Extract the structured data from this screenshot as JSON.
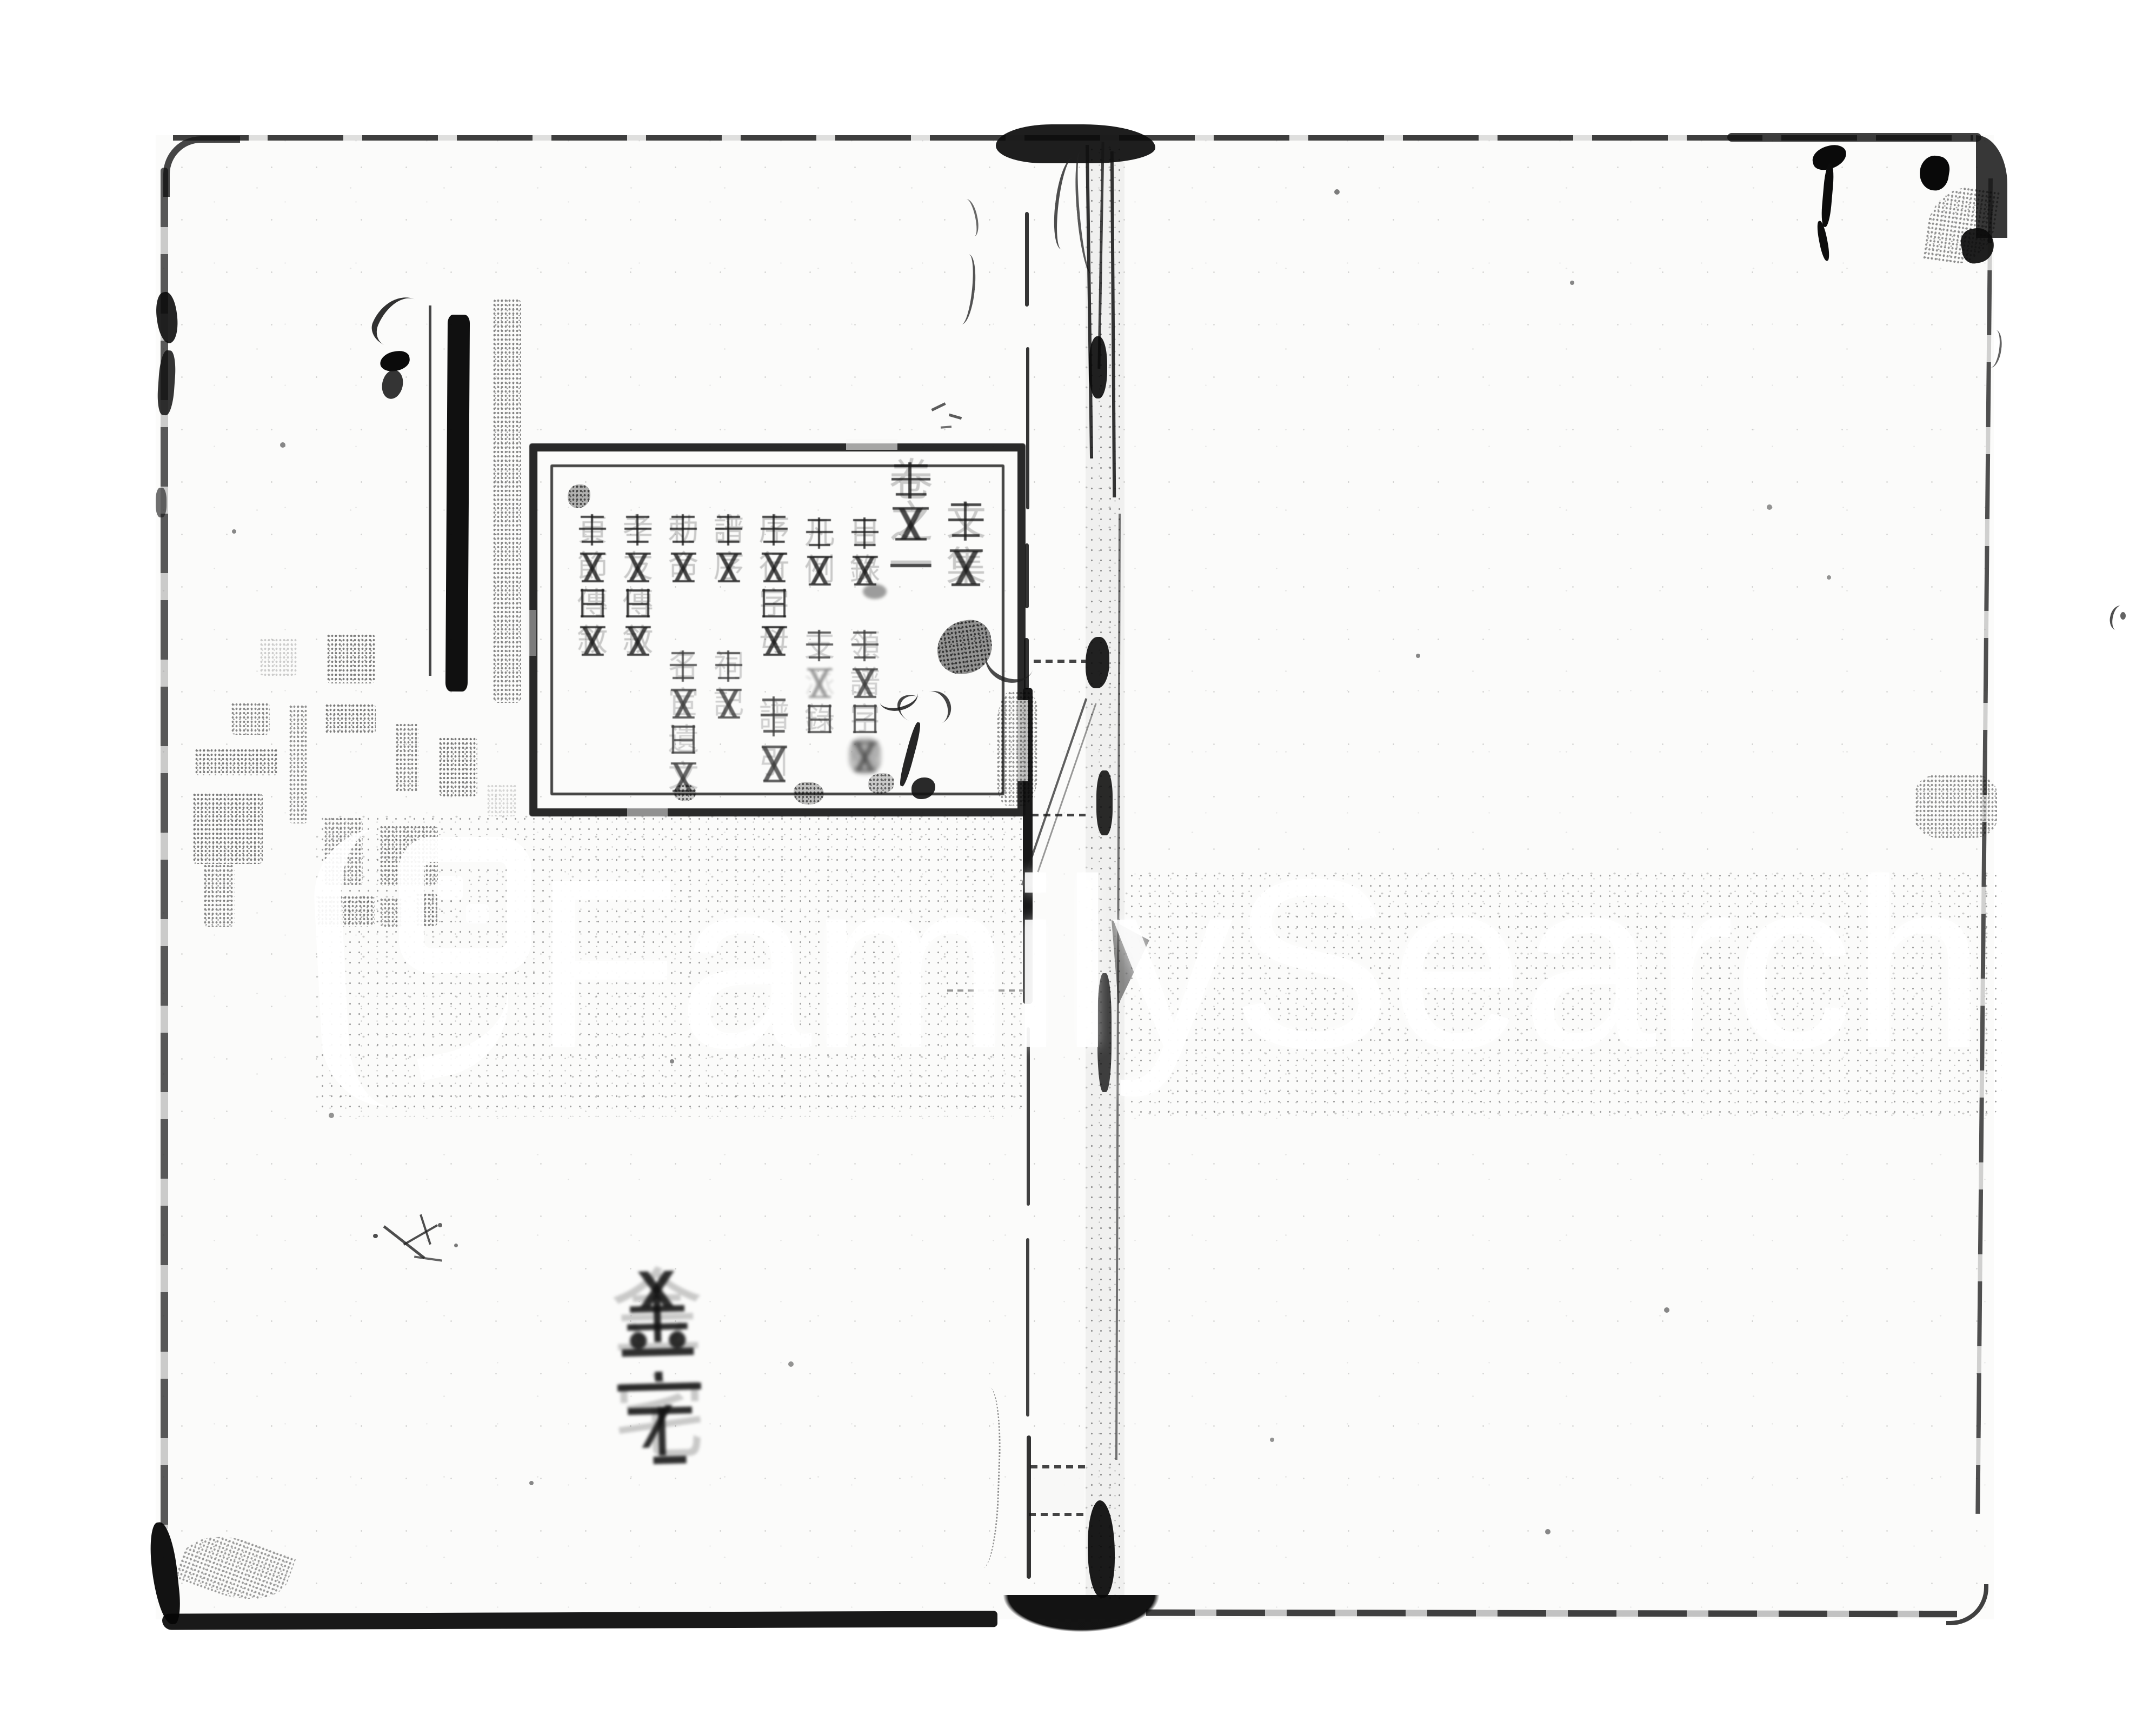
{
  "watermark": {
    "text": "FamilySearch.",
    "logo_icon": "familysearch-square-logo",
    "arc_glyph": "(",
    "color": "#ffffff"
  },
  "book": {
    "volume_box": {
      "series_title": "文集",
      "volume_title": "卷之一",
      "toc": [
        {
          "main": "目錄",
          "sub": "領譜字號"
        },
        {
          "main": "凡例",
          "sub": "支派錄"
        },
        {
          "main": "序行字母",
          "sub": "譜引"
        },
        {
          "main": "譜序",
          "sub": "祠記"
        },
        {
          "main": "勅命",
          "sub": "名宦遺文"
        },
        {
          "main": "孝友傳敘",
          "sub": ""
        },
        {
          "main": "貞節傳敘",
          "sub": ""
        }
      ]
    },
    "cover_label": "金宅"
  }
}
